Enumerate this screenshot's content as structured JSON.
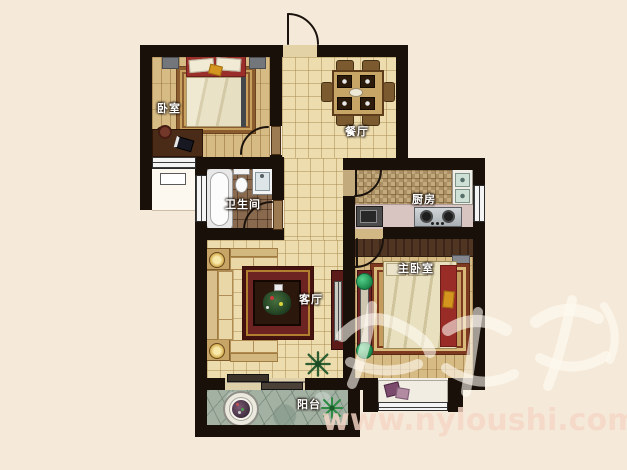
{
  "rooms": {
    "bedroom": {
      "label": "卧室"
    },
    "dining": {
      "label": "餐厅"
    },
    "bathroom": {
      "label": "卫生间"
    },
    "kitchen": {
      "label": "厨房"
    },
    "living": {
      "label": "客厅"
    },
    "master_bedroom": {
      "label": "主卧室"
    },
    "balcony": {
      "label": "阳台"
    }
  },
  "watermark": {
    "site_text": "www.nyloushi.com"
  },
  "colors": {
    "wall": "#19100a",
    "page_background": "#f5ead9",
    "tile_floor": "#ecdcae",
    "wood_floor": "#d7bb85",
    "bath_floor": "#8a6a4e",
    "kitchen_mosaic": "#c3aa7d",
    "balcony_stone": "#a3b1a3",
    "accent_red": "#9a2e2a",
    "watermark_text": "#f6d6c6"
  }
}
